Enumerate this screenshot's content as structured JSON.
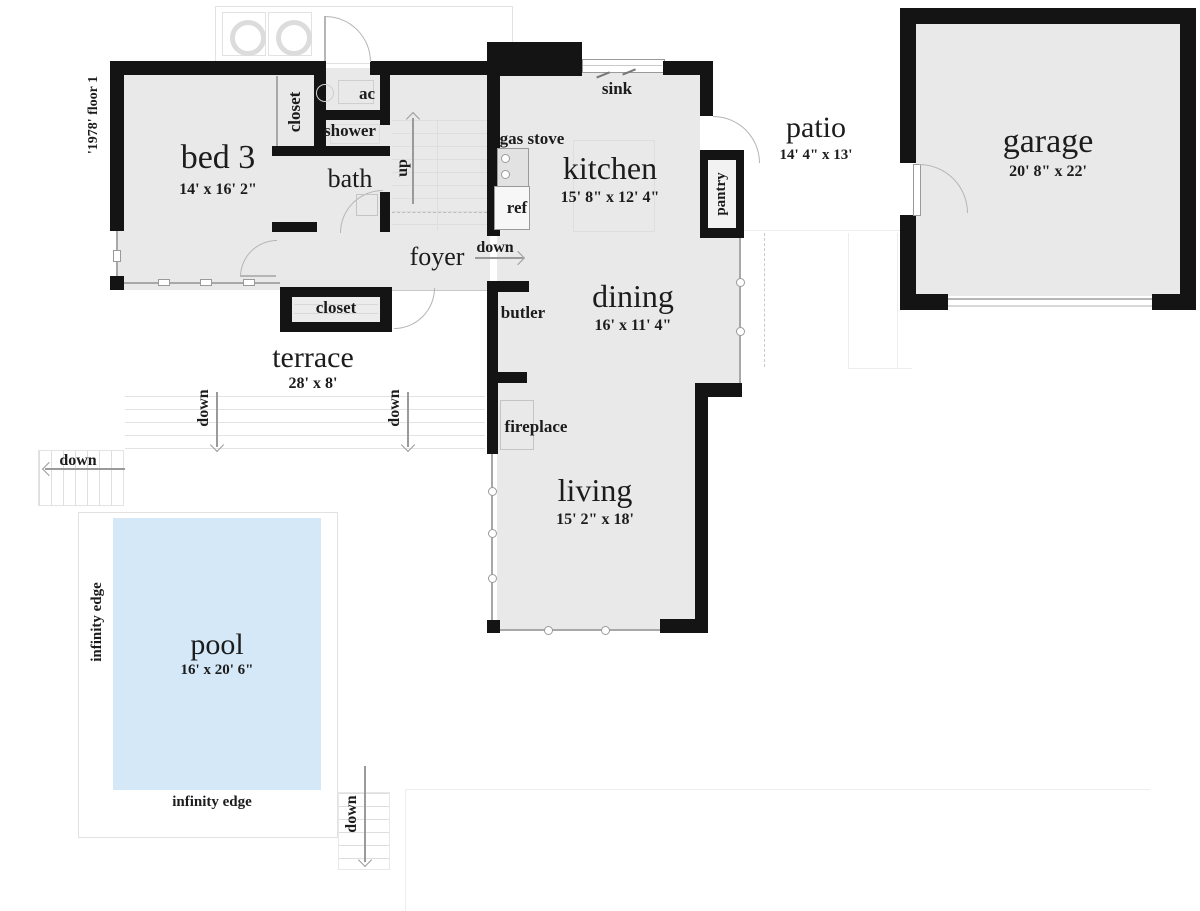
{
  "floor_tag": "'1978' floor 1",
  "rooms": {
    "bed3": {
      "name": "bed 3",
      "dims": "14' x 16' 2\""
    },
    "kitchen": {
      "name": "kitchen",
      "dims": "15' 8\" x 12' 4\""
    },
    "dining": {
      "name": "dining",
      "dims": "16' x 11' 4\""
    },
    "living": {
      "name": "living",
      "dims": "15' 2\" x 18'"
    },
    "garage": {
      "name": "garage",
      "dims": "20' 8\" x 22'"
    },
    "patio": {
      "name": "patio",
      "dims": "14' 4\" x 13'"
    },
    "terrace": {
      "name": "terrace",
      "dims": "28' x 8'"
    },
    "pool": {
      "name": "pool",
      "dims": "16' x 20' 6\""
    }
  },
  "features": {
    "closet_top": "closet",
    "closet_foyer": "closet",
    "ac": "ac",
    "shower": "shower",
    "bath": "bath",
    "foyer": "foyer",
    "sink": "sink",
    "gas_stove": "gas stove",
    "ref": "ref",
    "pantry": "pantry",
    "butler": "butler",
    "fireplace": "fireplace"
  },
  "directions": {
    "up": "up",
    "down": "down",
    "infinity_edge": "infinity edge"
  },
  "colors": {
    "wall": "#141414",
    "floor": "#e9e9e9",
    "pool_water": "#d5e8f8"
  }
}
